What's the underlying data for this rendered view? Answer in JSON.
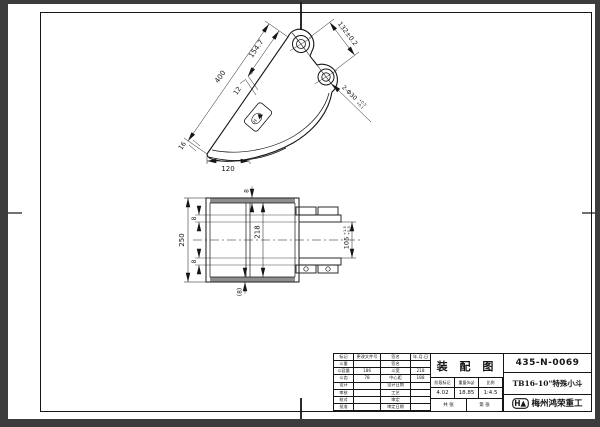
{
  "sheet": {
    "drawing_type": "装 配 图",
    "drawing_no": "435-N-0069",
    "part_name": "TB16-10\"特殊小斗",
    "company": "梅州鸿荣重工",
    "logo_letter": "H"
  },
  "title_block": {
    "left_rows": [
      [
        "标记",
        "更改文件号",
        "签名",
        "年.月.日"
      ],
      [
        "斗重",
        "",
        "签名",
        ""
      ],
      [
        "斗容量",
        "186",
        "斗宽",
        "218"
      ],
      [
        "斗齿",
        "78",
        "中心距",
        "188"
      ],
      [
        "设计",
        "",
        "设计日期",
        ""
      ],
      [
        "审核",
        "",
        "工艺",
        ""
      ],
      [
        "校对",
        "",
        "审定",
        ""
      ],
      [
        "批准",
        "",
        "审定日期",
        ""
      ]
    ],
    "info_headers": [
      "阶段标记",
      "重量(kg)",
      "比例"
    ],
    "info_values": [
      "4.02",
      "18.85",
      "1:4.5"
    ],
    "sheet_note_1": "共 张",
    "sheet_note_2": "第 张"
  },
  "side_view": {
    "dims": {
      "edge_len": "400",
      "edge_len2": "154.7",
      "hole_pitch": "132±0.2",
      "plate_offset": "12",
      "lip": "16",
      "bottom_len": "120",
      "holes": "2-Φ30",
      "holes_tol_up": "+0.5",
      "holes_tol_dn": "+0.1"
    }
  },
  "front_view": {
    "dims": {
      "overall": "250",
      "inner": "218",
      "t_top": "8",
      "t_ear_top": "8",
      "t_ear_bottom": "8",
      "t_ref": "(8)",
      "ear_gap": "105",
      "gap_tol_up": "+1.5",
      "gap_tol_dn": "+0.5"
    }
  }
}
